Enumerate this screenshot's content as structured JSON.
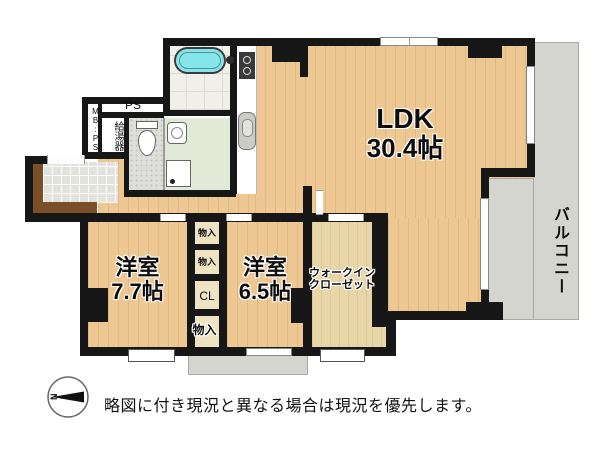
{
  "floorplan": {
    "rooms": {
      "ldk": {
        "name": "LDK",
        "size": "30.4帖"
      },
      "bedroom_left": {
        "name": "洋室",
        "size": "7.7帖"
      },
      "bedroom_center": {
        "name": "洋室",
        "size": "6.5帖"
      },
      "walk_in_closet": {
        "line1": "ウォークイン",
        "line2": "クローゼット"
      },
      "balcony": {
        "name": "バルコニー"
      },
      "closet": {
        "name": "CL"
      },
      "storage_top": {
        "name": "物入"
      },
      "storage_mid": {
        "name": "物入"
      },
      "storage_bottom": {
        "name": "物入"
      },
      "pipe_space": {
        "name": "PS"
      },
      "meter_box": {
        "name": "MB:PS"
      },
      "water_heater": {
        "name": "給湯器"
      }
    },
    "compass": {
      "north": "N"
    },
    "note": {
      "disclaimer": "略図に付き現況と異なる場合は現況を優先します。"
    },
    "colors": {
      "wood": "#eec893",
      "balcony_gray": "#d5d5d0",
      "wall_black": "#171717",
      "bathtub_teal": "#86e5e9"
    }
  }
}
